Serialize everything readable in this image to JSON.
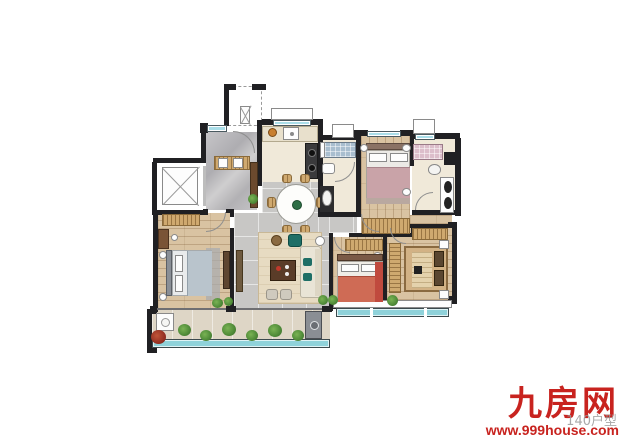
{
  "watermark": {
    "brand": "九房网",
    "url": "www.999house.com",
    "area_label": "140户型"
  },
  "colors": {
    "brand-red": "#c8231f",
    "wall-black": "#202023",
    "window-blue": "#aadee9",
    "glass-teal": "#8fd2da",
    "wood-floor": "#d9c3a2",
    "tile-gray": "#c8c7c5",
    "plant-green": "#4e8a38",
    "rug-beige": "#e7dbc2"
  }
}
